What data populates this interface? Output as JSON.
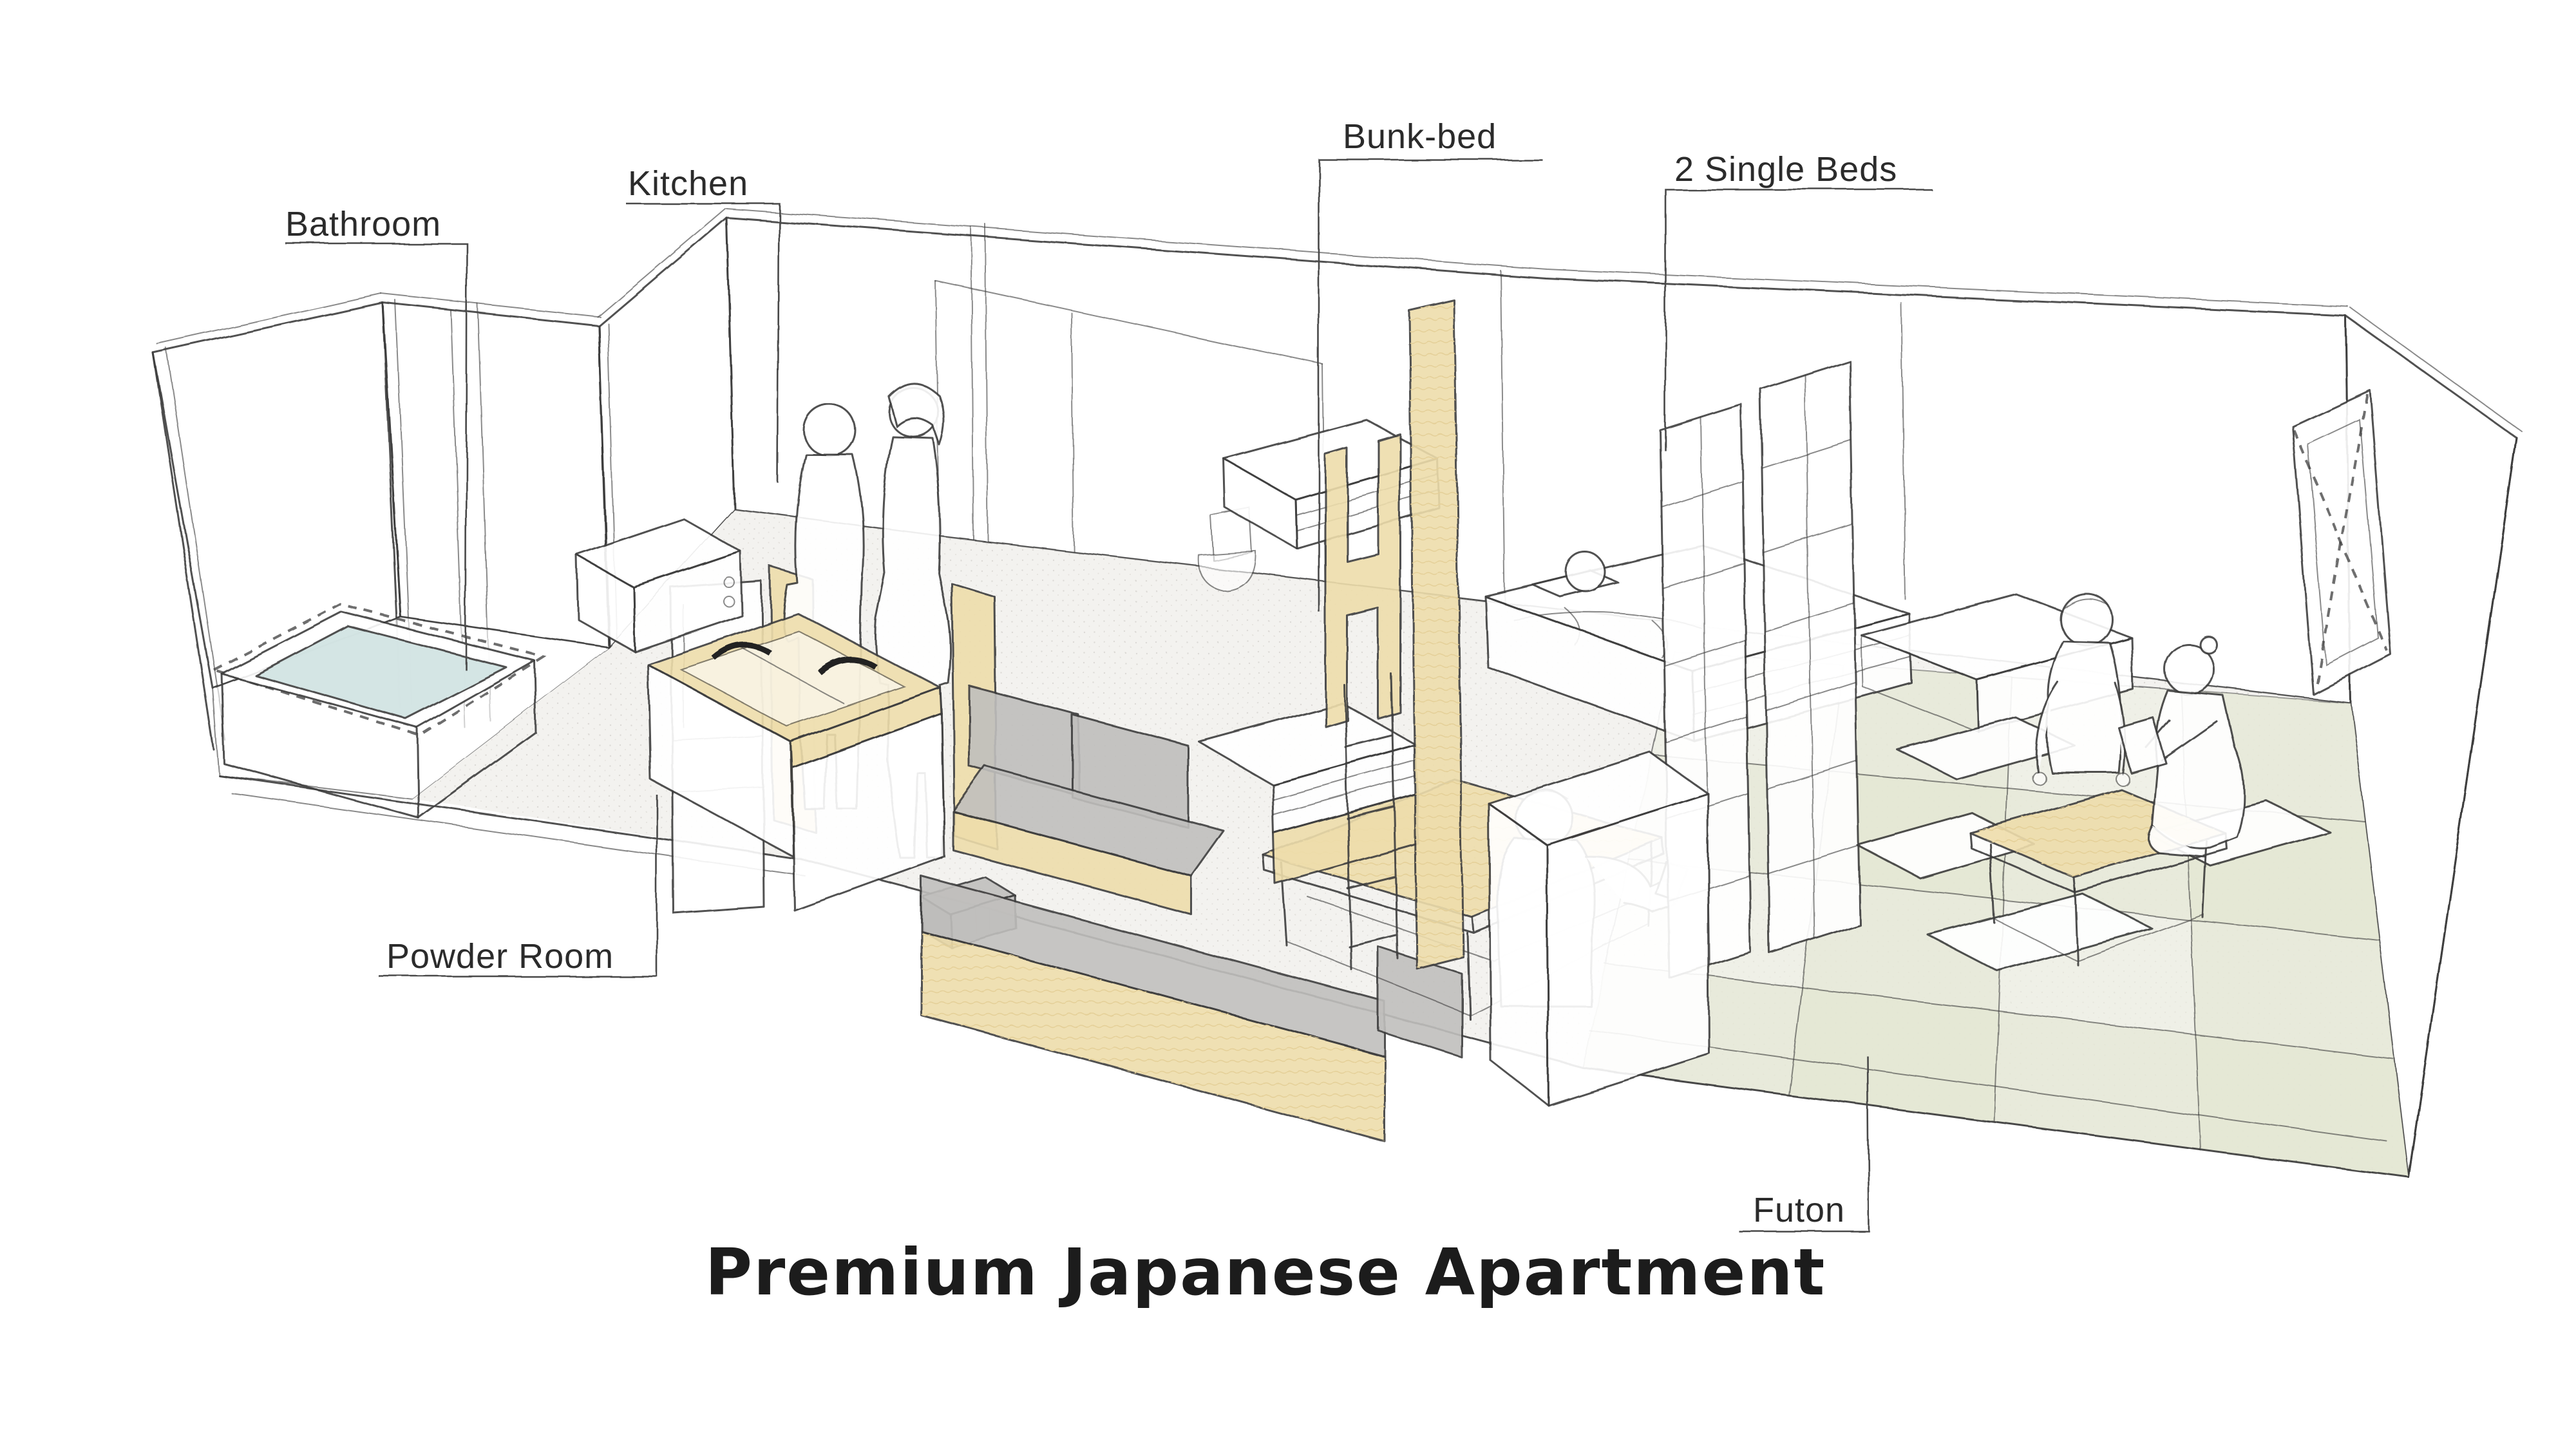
{
  "title": "Premium Japanese Apartment",
  "labels": {
    "bathroom": "Bathroom",
    "kitchen": "Kitchen",
    "bunk_bed": "Bunk-bed",
    "single_beds": "2 Single Beds",
    "powder_room": "Powder Room",
    "futon": "Futon"
  },
  "colors": {
    "paper": "#ffffff",
    "line": "#3d3d3d",
    "label_text": "#2b2b2b",
    "wood": "#eeddab",
    "wood_light": "#f3e7c3",
    "cushion_gray": "#c0bfbd",
    "cushion_gray_dark": "#a9a8a6",
    "bath_water": "#cfe2e1",
    "tatami": "#edefe1",
    "tatami_shade": "#e2e6d2",
    "floor_gray": "#f3f2ef"
  }
}
